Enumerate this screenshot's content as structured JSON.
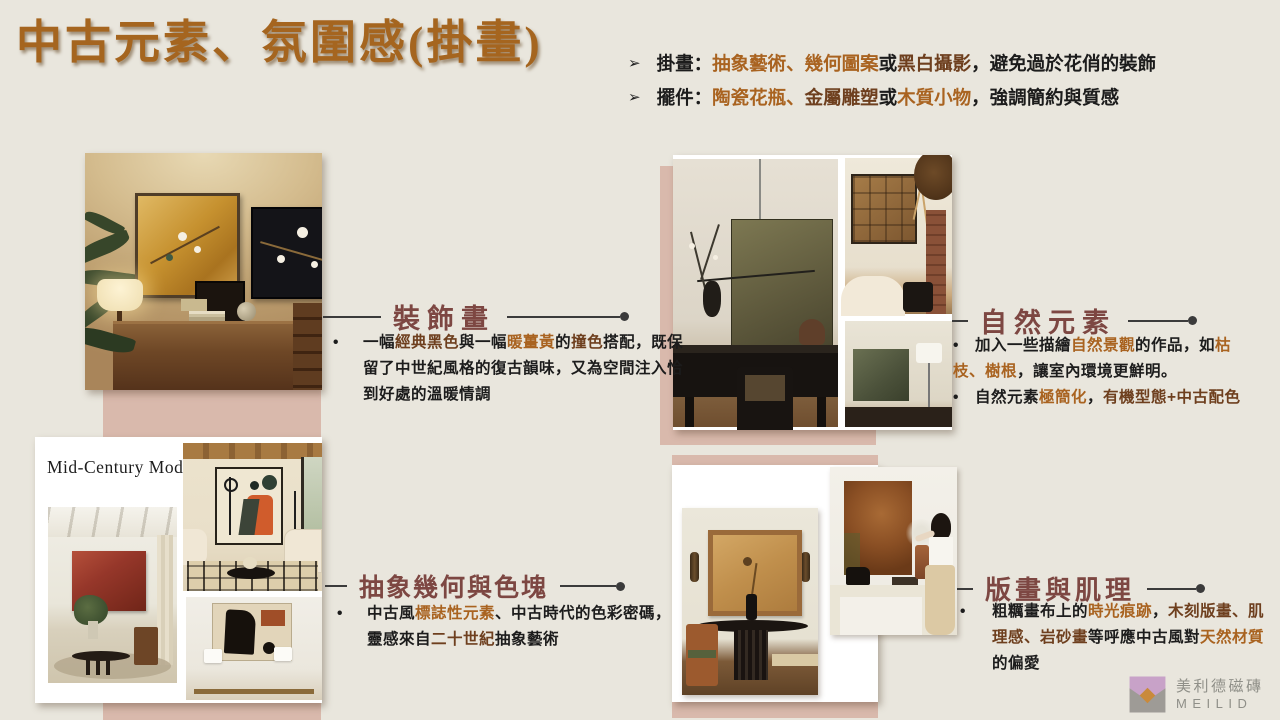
{
  "slide": {
    "title": "中古元素、氛圍感(掛畫)"
  },
  "intro": {
    "marker": "➢",
    "bullets": [
      {
        "segments": [
          {
            "t": "掛畫："
          },
          {
            "t": "抽象藝術、幾何圖案"
          },
          {
            "t": "或"
          },
          {
            "t": "黑白攝影"
          },
          {
            "t": "，避免過於花俏的裝飾"
          }
        ]
      },
      {
        "segments": [
          {
            "t": "擺件："
          },
          {
            "t": "陶瓷花瓶、"
          },
          {
            "t": "金屬雕塑"
          },
          {
            "t": "或"
          },
          {
            "t": "木質小物"
          },
          {
            "t": "，強調簡約與質感"
          }
        ]
      }
    ]
  },
  "sections": [
    {
      "caption": "裝飾畫",
      "bullet_marker": "•",
      "bullets": [
        {
          "segments": [
            {
              "t": "一幅"
            },
            {
              "t": "經典黑色"
            },
            {
              "t": "與一幅"
            },
            {
              "t": "暖薑黃"
            },
            {
              "t": "的"
            },
            {
              "t": "撞色"
            },
            {
              "t": "搭配，既保留了中世紀風格的復古韻味，又為空間注入恰到好處的溫暖情調"
            }
          ]
        }
      ]
    },
    {
      "caption": "自然元素",
      "bullet_marker": "•",
      "bullets": [
        {
          "segments": [
            {
              "t": "加入一些描繪"
            },
            {
              "t": "自然景觀"
            },
            {
              "t": "的作品，如"
            },
            {
              "t": "枯枝、樹根"
            },
            {
              "t": "，讓室內環境更鮮明。"
            }
          ]
        },
        {
          "segments": [
            {
              "t": "自然元素"
            },
            {
              "t": "極簡化"
            },
            {
              "t": "，"
            },
            {
              "t": "有機型態+中古配色"
            }
          ]
        }
      ]
    },
    {
      "caption": "抽象幾何與色塊",
      "collage_label": "Mid-Century Modern",
      "bullet_marker": "•",
      "bullets": [
        {
          "segments": [
            {
              "t": "中古風"
            },
            {
              "t": "標誌性元素"
            },
            {
              "t": "、中古時代的色彩密碼，靈感來自"
            },
            {
              "t": "二十世紀"
            },
            {
              "t": "抽象藝術"
            }
          ]
        }
      ]
    },
    {
      "caption": "版畫與肌理",
      "bullet_marker": "•",
      "bullets": [
        {
          "segments": [
            {
              "t": "粗糲畫布上的"
            },
            {
              "t": "時光痕跡"
            },
            {
              "t": "，"
            },
            {
              "t": "木刻版畫、肌理感、岩砂畫"
            },
            {
              "t": "等呼應中古風對"
            },
            {
              "t": "天然材質"
            },
            {
              "t": "的偏愛"
            }
          ]
        }
      ]
    }
  ],
  "logo": {
    "brand": "美利德磁磚",
    "latin": "MEILID"
  },
  "colors": {
    "background": "#E9E6DD",
    "title": "#A5651F",
    "caption": "#7D4742",
    "highlight_orange": "#A96320",
    "highlight_brown": "#6E3F1E",
    "pink_block": "#D9B9AC",
    "line": "#3B3B3B"
  }
}
